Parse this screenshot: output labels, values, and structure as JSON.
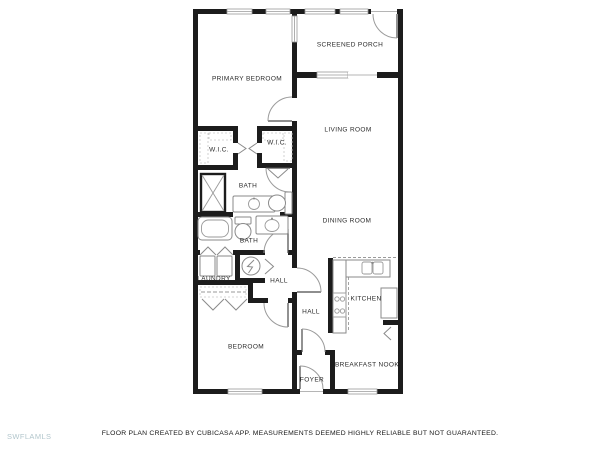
{
  "watermark": "SWFLAMLS",
  "footer": {
    "disclaimer": "FLOOR PLAN CREATED BY CUBICASA APP. MEASUREMENTS DEEMED HIGHLY RELIABLE BUT NOT GUARANTEED."
  },
  "colors": {
    "wall": "#1c1c1c",
    "fixture_outline": "#8a8a8a",
    "label_text": "#2b2b2b",
    "watermark_text": "#b2c6cc"
  },
  "floor_plan": {
    "rooms": [
      {
        "id": "primary-bedroom",
        "label": "PRIMARY BEDROOM"
      },
      {
        "id": "screened-porch",
        "label": "SCREENED PORCH"
      },
      {
        "id": "living-room",
        "label": "LIVING ROOM"
      },
      {
        "id": "wic-left",
        "label": "W.I.C."
      },
      {
        "id": "wic-right",
        "label": "W.I.C."
      },
      {
        "id": "bath-upper",
        "label": "BATH"
      },
      {
        "id": "dining-room",
        "label": "DINING ROOM"
      },
      {
        "id": "bath-lower",
        "label": "BATH"
      },
      {
        "id": "laundry",
        "label": "LAUNDRY"
      },
      {
        "id": "hall-upper",
        "label": "HALL"
      },
      {
        "id": "hall-lower",
        "label": "HALL"
      },
      {
        "id": "kitchen",
        "label": "KITCHEN"
      },
      {
        "id": "bedroom",
        "label": "BEDROOM"
      },
      {
        "id": "breakfast-nook",
        "label": "BREAKFAST NOOK"
      },
      {
        "id": "foyer",
        "label": "FOYER"
      }
    ]
  }
}
